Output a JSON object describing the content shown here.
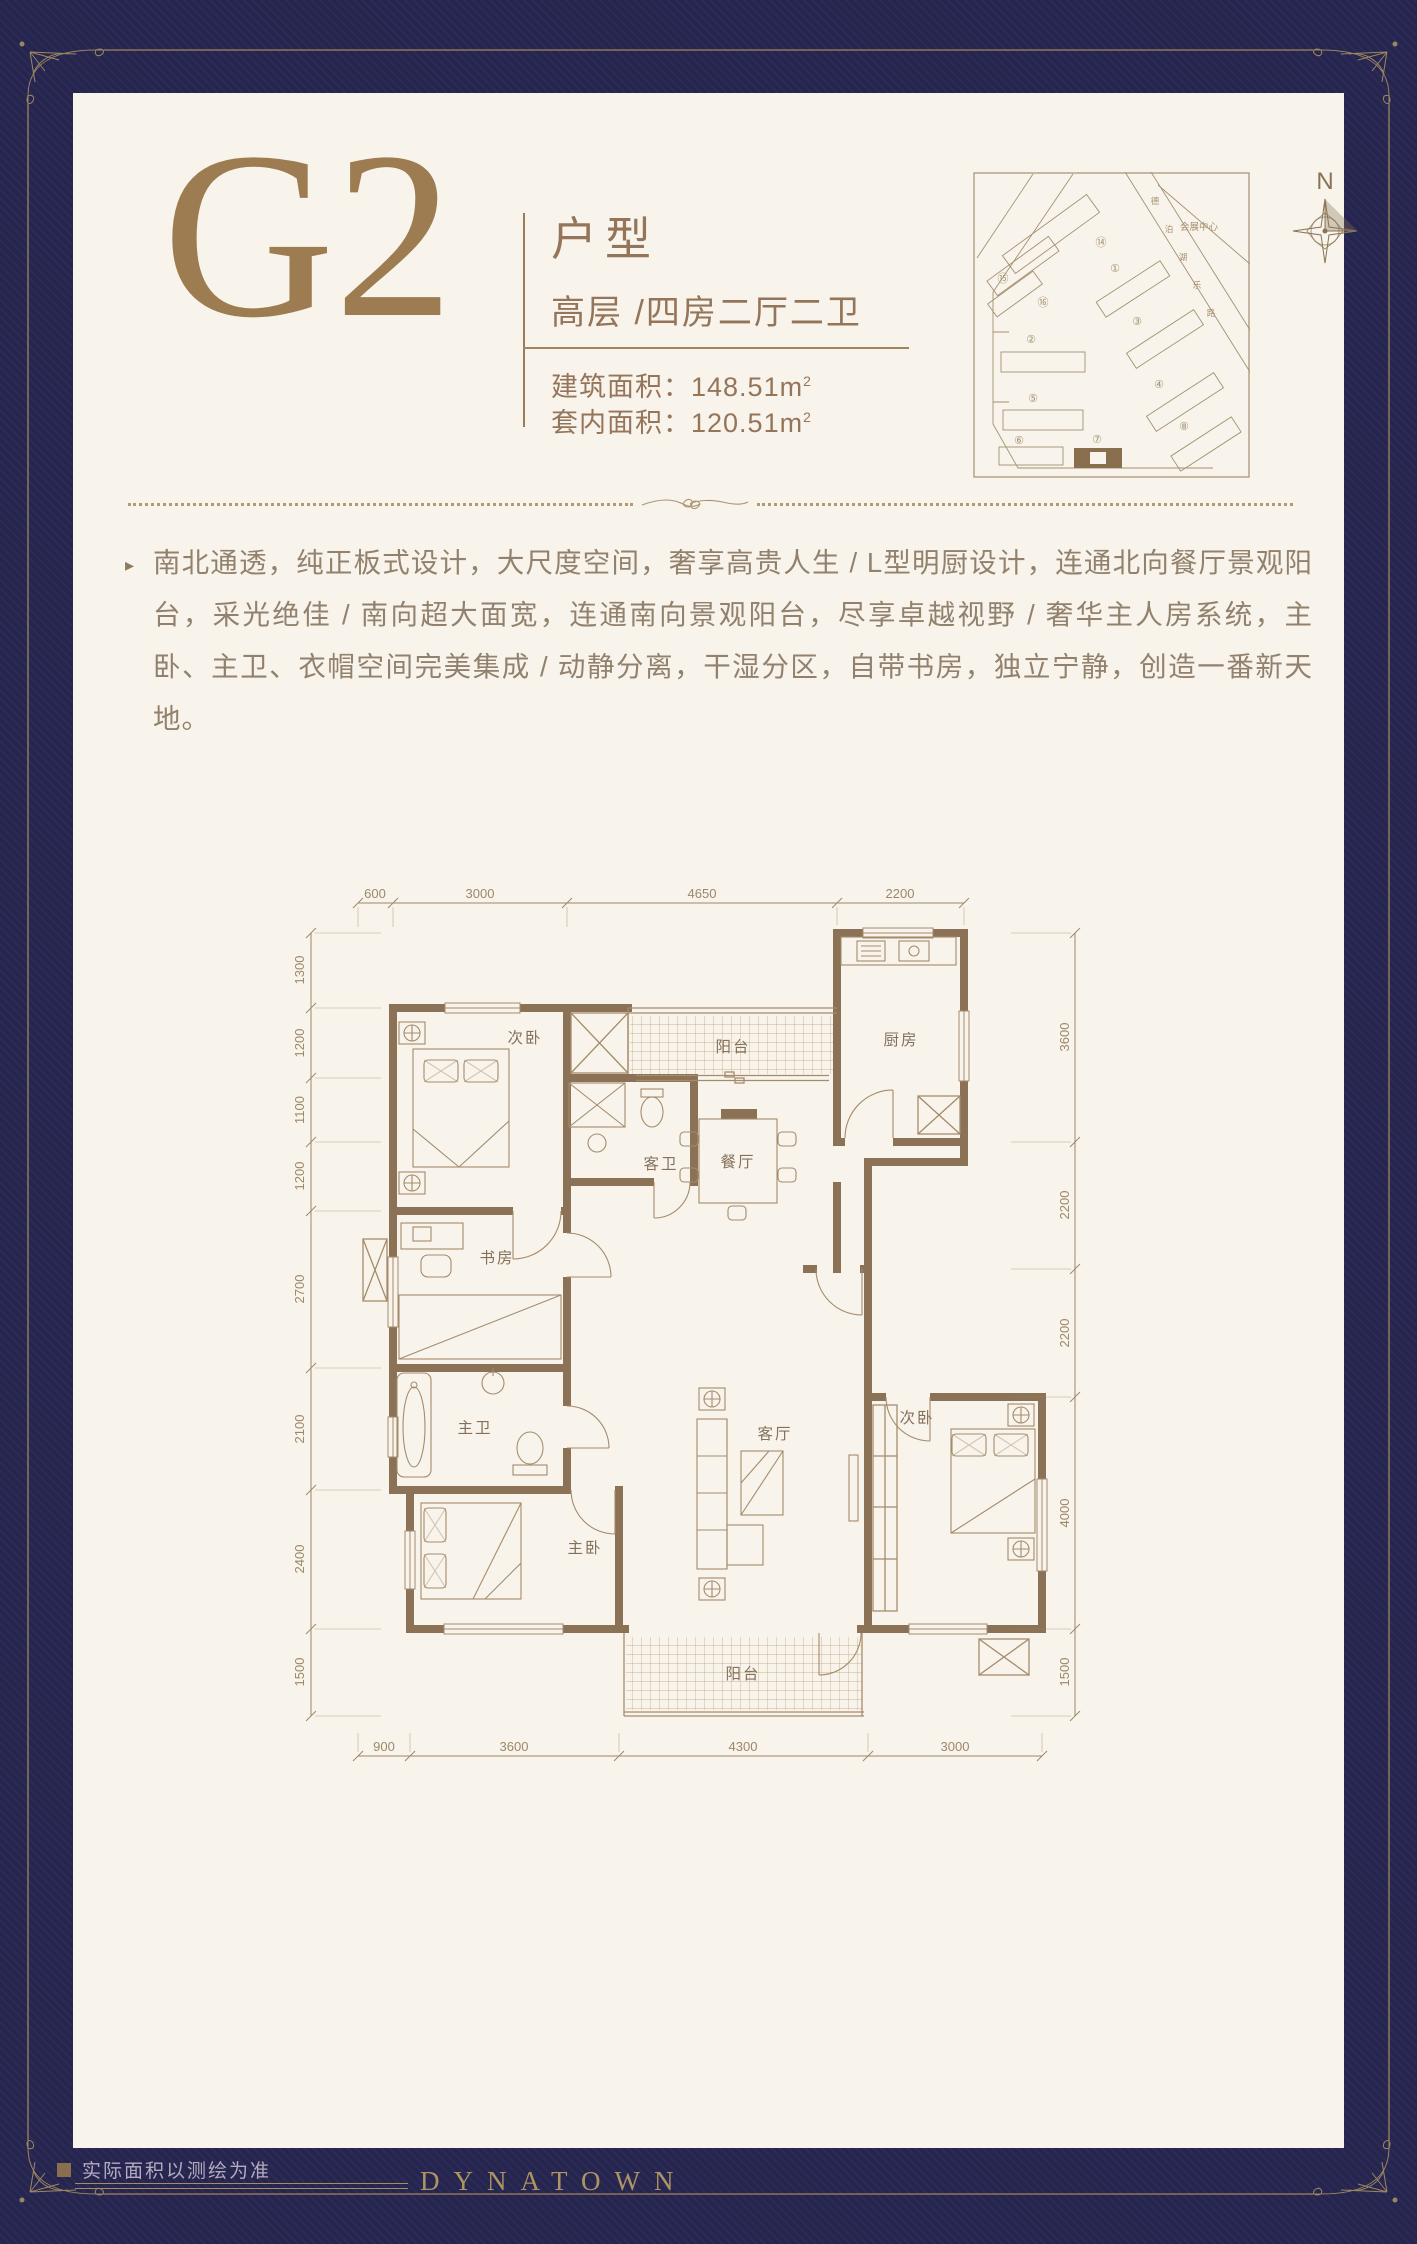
{
  "colors": {
    "navy": "#26254e",
    "navy_stripe": "#2c2b58",
    "cream": "#f8f4ec",
    "gold": "#9c8660",
    "brown": "#95755a",
    "wall": "#8b7155",
    "line": "#a58b6b",
    "dim": "#9d8769",
    "desc": "#92816c",
    "footer_note": "#b3abbe",
    "accent_dark": "#8a6f4e"
  },
  "header": {
    "unit_code": "G2",
    "category": "户型",
    "type_line": "高层 /四房二厅二卫",
    "areas": [
      {
        "label": "建筑面积：",
        "value": "148.51m",
        "sup": "2"
      },
      {
        "label": "套内面积：",
        "value": "120.51m",
        "sup": "2"
      }
    ]
  },
  "site_plan": {
    "landmark": "会展中心",
    "north": "N",
    "road": [
      "德",
      "泊",
      "湖",
      "乐",
      "路"
    ],
    "buildings": [
      "⑭",
      "⑮",
      "⑯",
      "①",
      "②",
      "③",
      "④",
      "⑤",
      "⑥",
      "⑦",
      "⑧"
    ],
    "highlight_building": "⑦"
  },
  "description": {
    "bullet": "▸",
    "text": "南北通透，纯正板式设计，大尺度空间，奢享高贵人生 / L型明厨设计，连通北向餐厅景观阳台，采光绝佳 / 南向超大面宽，连通南向景观阳台，尽享卓越视野 / 奢华主人房系统，主卧、主卫、衣帽空间完美集成 / 动静分离，干湿分区，自带书房，独立宁静，创造一番新天地。"
  },
  "floor_plan": {
    "rooms": [
      "次卧",
      "阳台",
      "厨房",
      "客卫",
      "餐厅",
      "书房",
      "主卫",
      "客厅",
      "主卧",
      "次卧",
      "阳台"
    ],
    "dims": {
      "top": [
        "600",
        "3000",
        "4650",
        "2200"
      ],
      "bottom": [
        "900",
        "3600",
        "4300",
        "3000"
      ],
      "left": [
        "1300",
        "1200",
        "1100",
        "1200",
        "2700",
        "2100",
        "2400",
        "1500"
      ],
      "right": [
        "3600",
        "2200",
        "2200",
        "4000",
        "1500"
      ]
    }
  },
  "footer": {
    "note": "实际面积以测绘为准",
    "brand": "DYNATOWN"
  }
}
